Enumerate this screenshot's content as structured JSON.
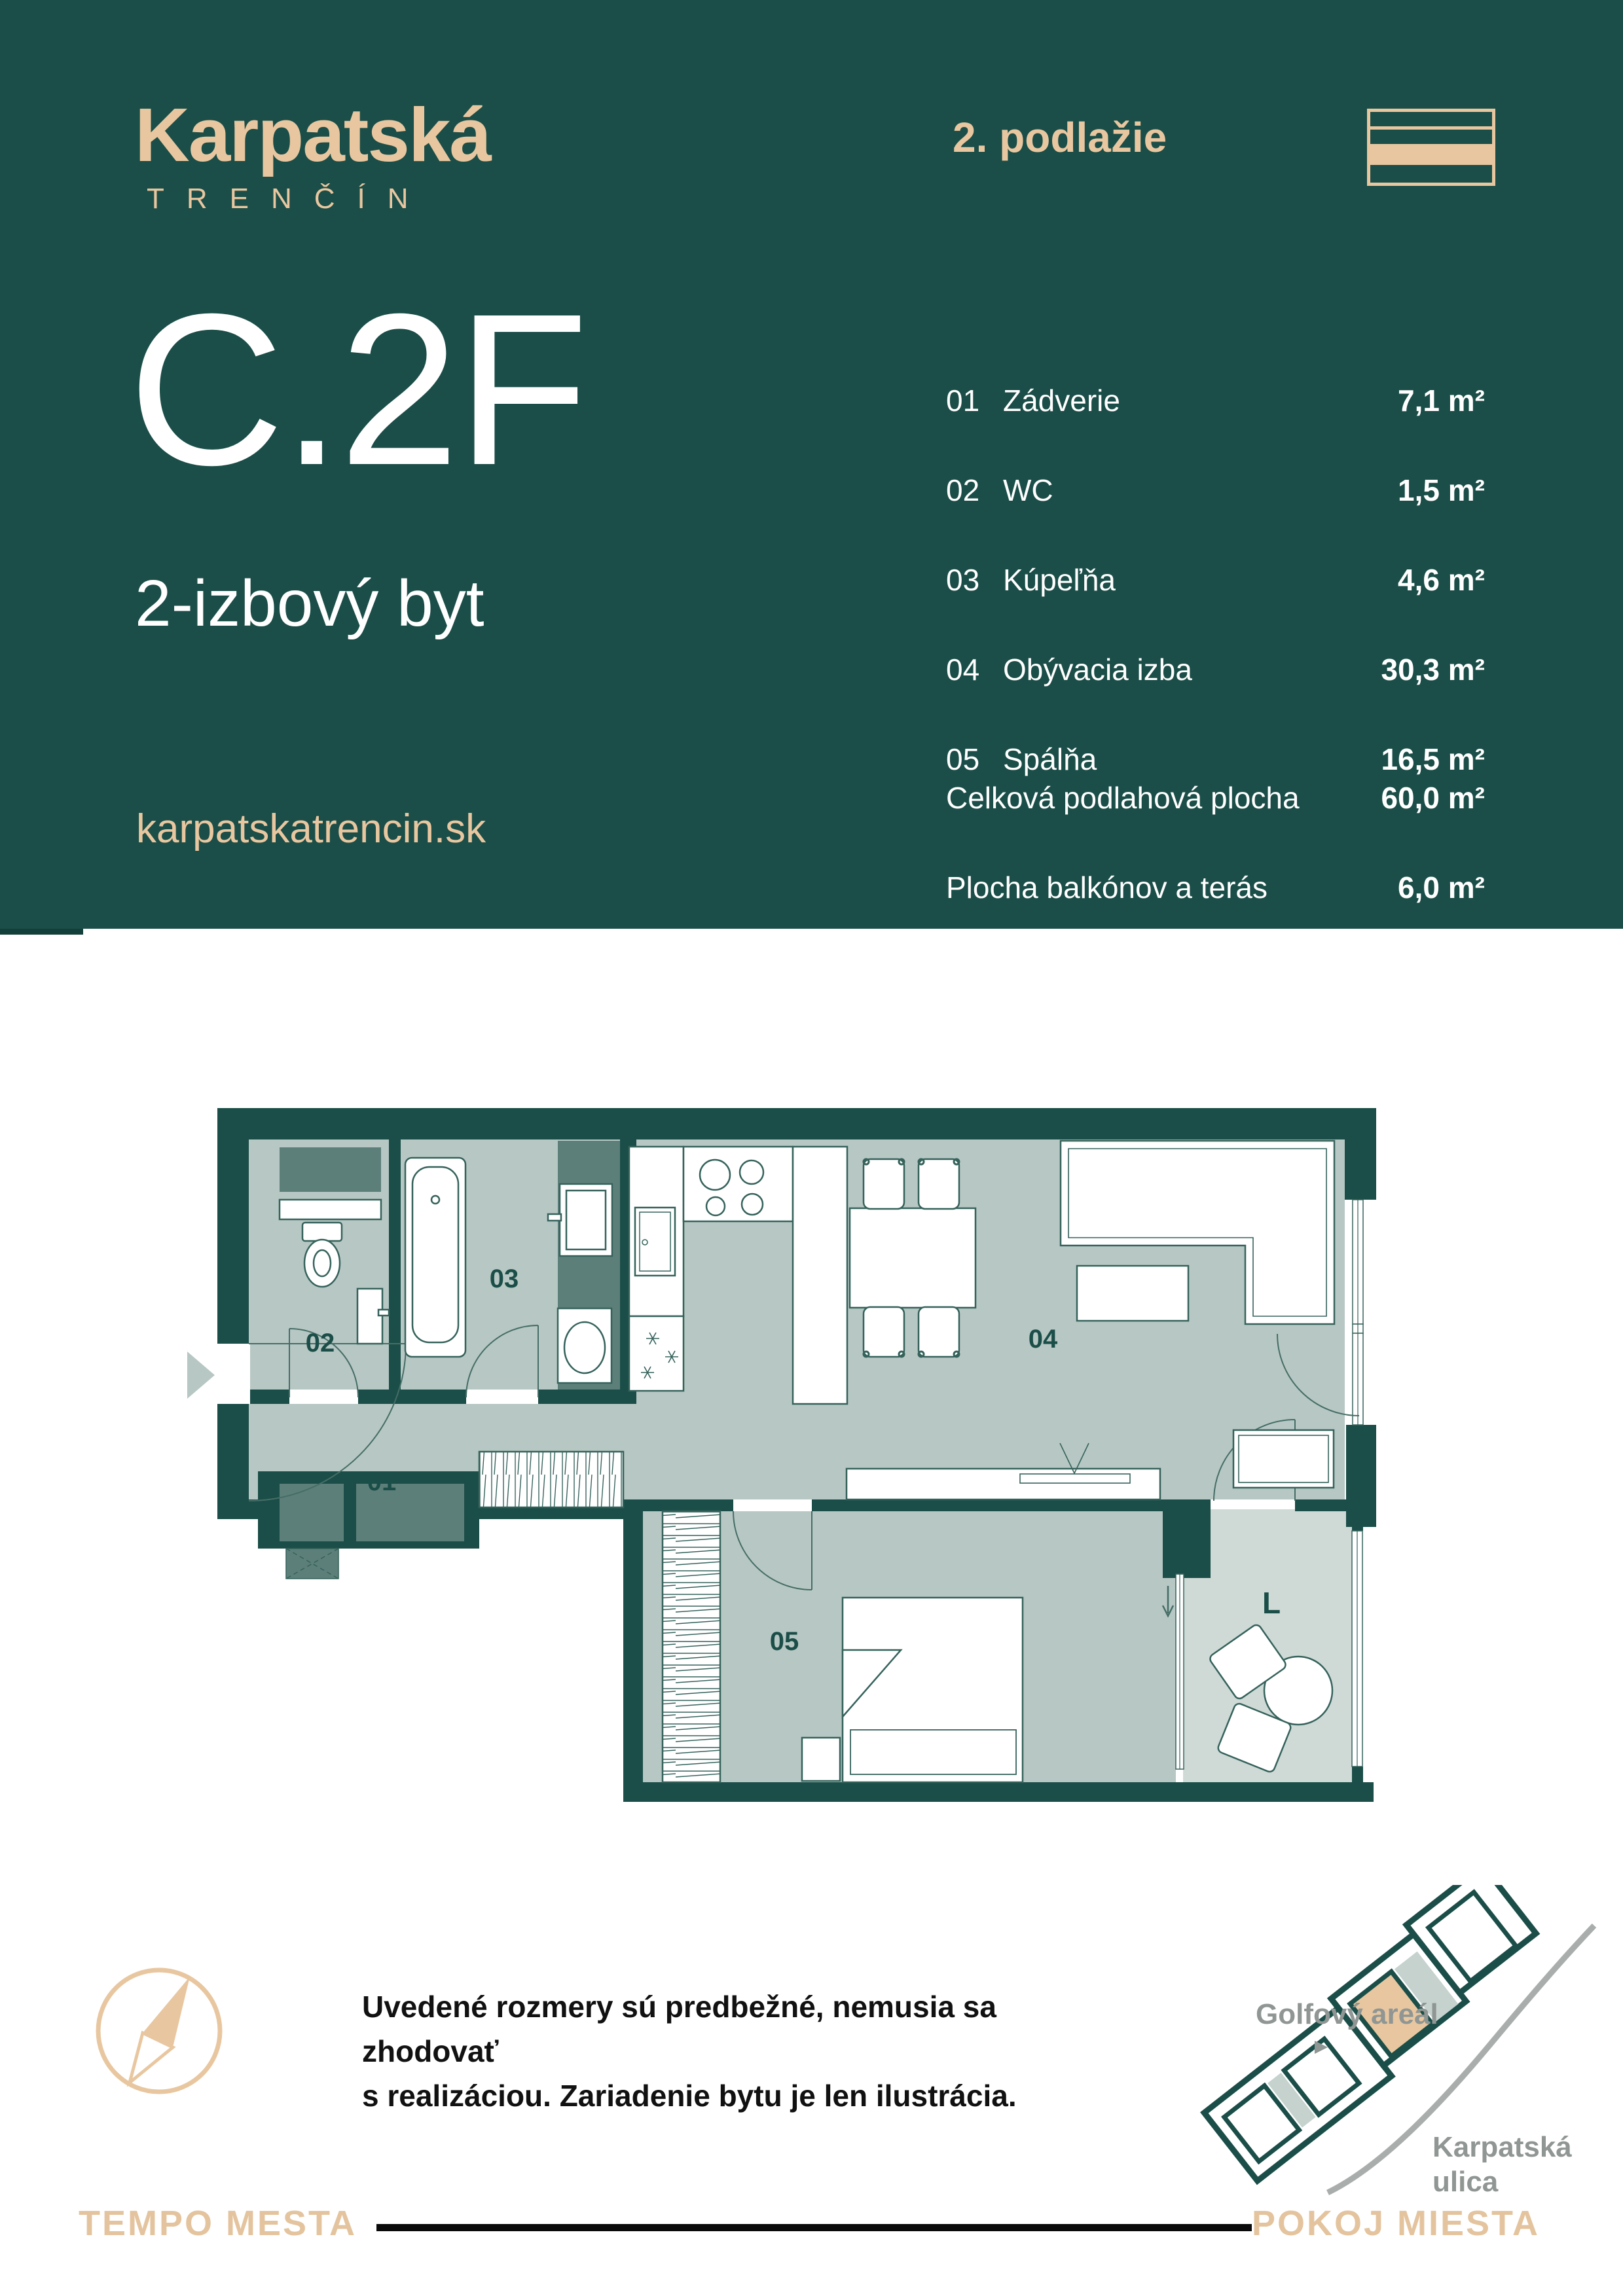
{
  "colors": {
    "teal": "#1b4e48",
    "cream": "#e8c7a0",
    "white": "#ffffff",
    "floor": "#b7c7c3",
    "floor_light": "#cfdad6",
    "mid_teal": "#5d7f7a",
    "plan_line": "#2c5b54",
    "map_gray": "#8f9693",
    "black": "#0a0a0a"
  },
  "header": {
    "brand": "Karpatská",
    "brand_sub": "TRENČÍN",
    "floor_label": "2. podlažie",
    "unit_code": "C.2F",
    "unit_type": "2-izbový byt",
    "website": "karpatskatrencin.sk"
  },
  "rooms": [
    {
      "num": "01",
      "name": "Zádverie",
      "area": "7,1 m²"
    },
    {
      "num": "02",
      "name": "WC",
      "area": "1,5 m²"
    },
    {
      "num": "03",
      "name": "Kúpeľňa",
      "area": "4,6 m²"
    },
    {
      "num": "04",
      "name": "Obývacia izba",
      "area": "30,3 m²"
    },
    {
      "num": "05",
      "name": "Spálňa",
      "area": "16,5 m²"
    }
  ],
  "totals": [
    {
      "label": "Celková podlahová plocha",
      "value": "60,0 m²"
    },
    {
      "label": "Plocha balkónov a terás",
      "value": "6,0 m²"
    }
  ],
  "plan": {
    "labels": {
      "r01": "01",
      "r02": "02",
      "r03": "03",
      "r04": "04",
      "r05": "05",
      "loggia": "L"
    }
  },
  "disclaimer": {
    "line1": "Uvedené rozmery sú predbežné, nemusia sa zhodovať",
    "line2": "s realizáciou. Zariadenie bytu je len ilustrácia."
  },
  "map": {
    "area_label": "Golfový areál",
    "street_label_line1": "Karpatská",
    "street_label_line2": "ulica"
  },
  "footer": {
    "left": "TEMPO MESTA",
    "right": "POKOJ MIESTA"
  }
}
